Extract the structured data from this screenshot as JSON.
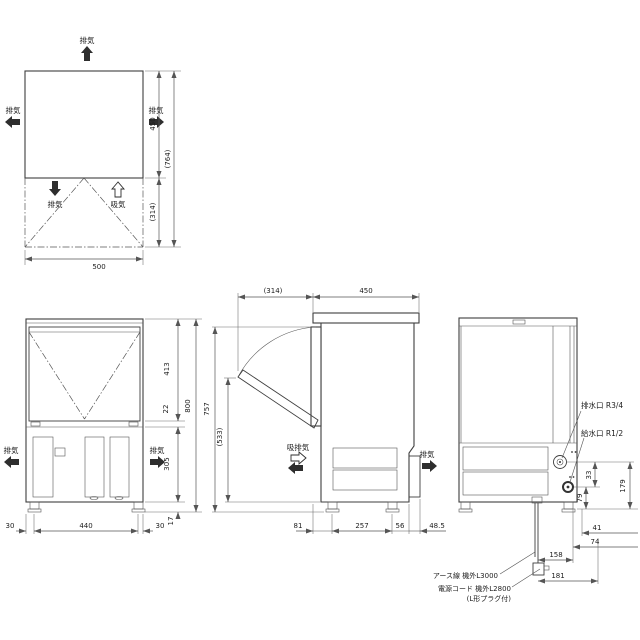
{
  "drawing": {
    "labels": {
      "exhaust": "排気",
      "intake": "吸気",
      "intake_exhaust": "吸排気",
      "drain_port": "排水口  R3/4",
      "supply_port": "給水口  R1/2",
      "earth_wire": "アース線 機外L3000",
      "power_cord": "電源コード 機外L2800",
      "power_cord_note": "(L形プラグ付)"
    },
    "top_view": {
      "dims": {
        "depth": "450",
        "total_depth": "(764)",
        "door_open": "(314)",
        "width": "500"
      }
    },
    "front_view": {
      "dims": {
        "door_height": "413",
        "divider": "22",
        "height": "800",
        "base_height": "305",
        "leg": "17",
        "side_left": "30",
        "width": "440",
        "side_right": "30"
      }
    },
    "side_view": {
      "dims": {
        "door_open": "(314)",
        "depth": "450",
        "height": "757",
        "open_height": "(533)",
        "front_leg": "81",
        "leg_pitch": "257",
        "rear_leg": "56",
        "rear_duct": "48.5"
      }
    },
    "rear_view": {
      "dims": {
        "port_pitch": "33",
        "drain_height": "179",
        "supply_height": "79",
        "offset_a": "41",
        "offset_b": "74",
        "offset_c": "158",
        "offset_d": "181"
      }
    }
  },
  "colors": {
    "background": "#ffffff",
    "line": "#3e3e3e",
    "dimension_line": "#555555",
    "text": "#1c1c1c",
    "vent_slat": "#8f8f8f",
    "vent_background": "#e6e6e6"
  }
}
